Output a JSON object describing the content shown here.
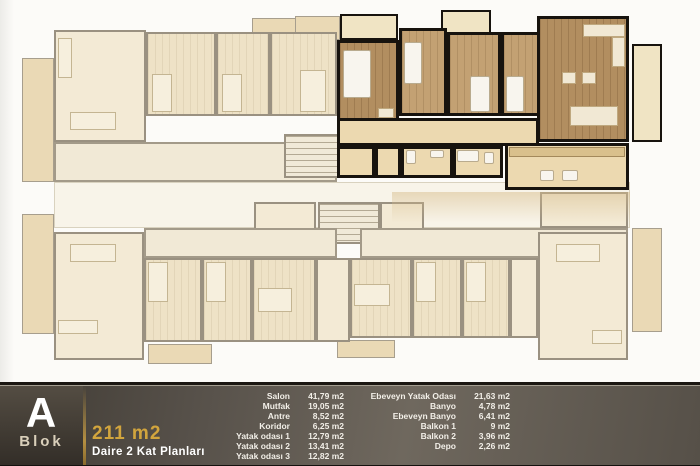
{
  "block": {
    "letter": "A",
    "name": "Blok"
  },
  "plan": {
    "area_label": "211 m2",
    "subtitle": "Daire 2 Kat Planları"
  },
  "rooms": {
    "col1": [
      {
        "name": "Salon",
        "area": "41,79  m2"
      },
      {
        "name": "Mutfak",
        "area": "19,05  m2"
      },
      {
        "name": "Antre",
        "area": "8,52  m2"
      },
      {
        "name": "Koridor",
        "area": "6,25  m2"
      },
      {
        "name": "Yatak odası 1",
        "area": "12,79  m2"
      },
      {
        "name": "Yatak odası 2",
        "area": "13,41  m2"
      },
      {
        "name": "Yatak odası 3",
        "area": "12,82  m2"
      }
    ],
    "col2": [
      {
        "name": "Ebeveyn Yatak Odası",
        "area": "21,63  m2"
      },
      {
        "name": "Banyo",
        "area": "4,78  m2"
      },
      {
        "name": "Ebeveyn Banyo",
        "area": "6,41  m2"
      },
      {
        "name": "Balkon 1",
        "area": "9  m2"
      },
      {
        "name": "Balkon 2",
        "area": "3,96  m2"
      },
      {
        "name": "Depo",
        "area": "2,26  m2"
      }
    ]
  },
  "colors": {
    "accent_gold": "#d2a53d",
    "highlight_wall": "#17130e",
    "highlight_floor": "#b28e60",
    "faded_floor": "#f3ead5",
    "faded_wall": "#9a9181",
    "bar_background": "#57514a"
  }
}
